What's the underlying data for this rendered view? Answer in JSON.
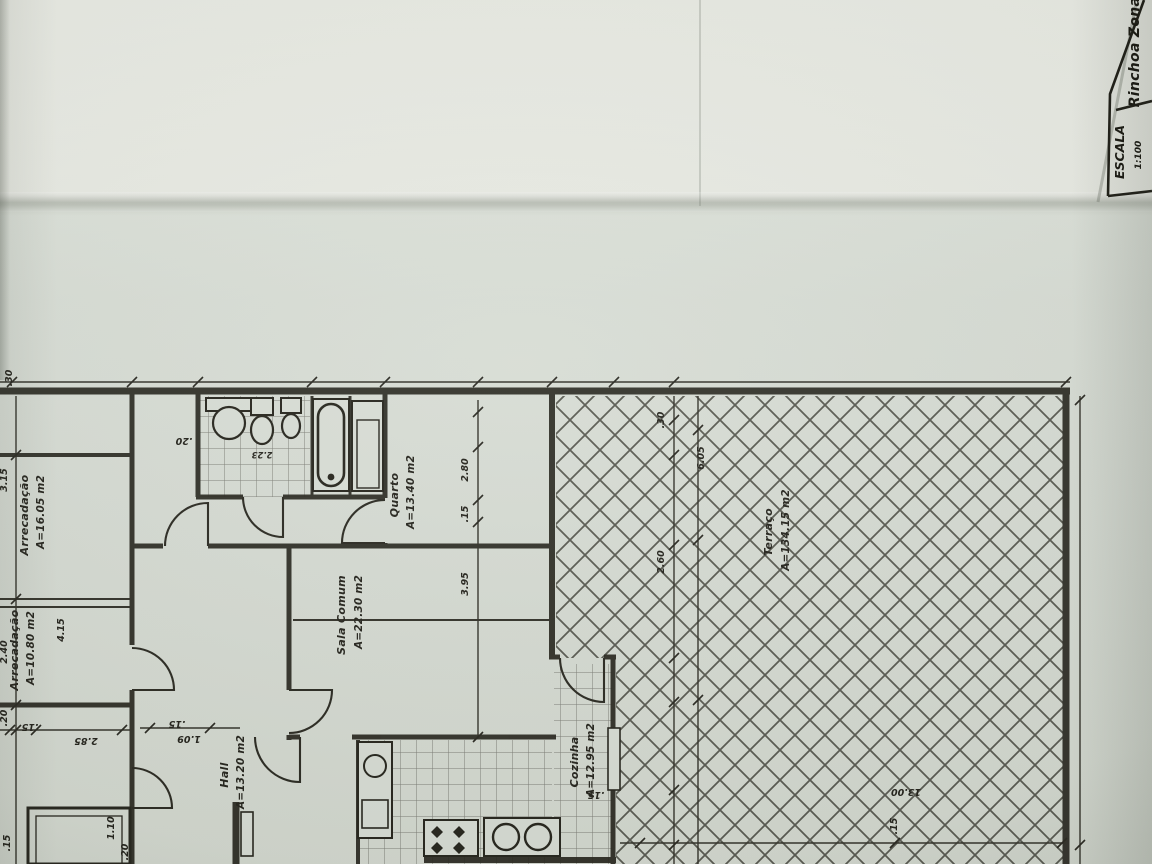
{
  "title_block": {
    "escala_label": "ESCALA",
    "escala_value": "1:100",
    "project_zone": "Rinchoa Zona"
  },
  "rooms": [
    {
      "name": "Arrecadação",
      "area": "A=16.05 m2"
    },
    {
      "name": "Arrecadação",
      "area": "A=10.80 m2"
    },
    {
      "name": "Quarto",
      "area": "A=13.40 m2"
    },
    {
      "name": "Sala Comum",
      "area": "A=22.30 m2"
    },
    {
      "name": "Hall",
      "area": "A=13.20 m2"
    },
    {
      "name": "Cozinha",
      "area": "A=12.95 m2"
    },
    {
      "name": "Terraço",
      "area": "A=134.15 m2"
    }
  ],
  "dims": [
    ".30",
    "3.15",
    "2.40",
    ".20",
    "4.15",
    "2.85",
    ".15",
    "1.10",
    ".20",
    ".15",
    ".20",
    ".15",
    "1.09",
    "2.80",
    ".15",
    "3.95",
    "2.23",
    ".15",
    ".30",
    "6.05",
    "2.60",
    "13.00",
    ".15"
  ],
  "colors": {
    "ink": "#2b2a23",
    "paper": "#d8ddd5",
    "paper_bright": "#e9ece5"
  }
}
